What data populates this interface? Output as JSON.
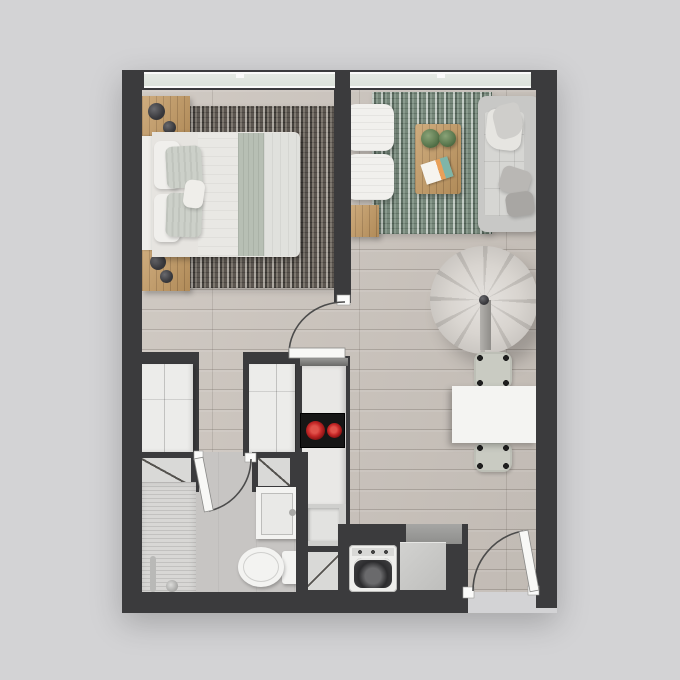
{
  "scene": {
    "kind": "studio-apartment-floor-plan",
    "view": "top-down-3d-render",
    "rooms": [
      "bedroom",
      "living-area",
      "dining-area",
      "kitchenette",
      "bathroom",
      "laundry-nook",
      "entry"
    ]
  },
  "colors": {
    "bg": "#d3d3d5",
    "wall": "#3b3b3d",
    "floorWood": "#ccc5be",
    "floorBath": "#c7c5c3",
    "windowGlass": "#e4e9e3",
    "windowFrame": "#fafaf9",
    "rugBedroomDark": "#6e6963",
    "rugLivingBase": "#8f9e92",
    "furnWood": "#c49a62",
    "white": "#f1f0ed",
    "linen": "#e9e8e4",
    "sage": "#b7bfb4",
    "grayLight": "#d6d6d3",
    "sofa": "#c8c8c6",
    "millworkWhite": "#ececea",
    "panelGray": "#d9d9d7",
    "cooktop": "#161616",
    "burnerRed": "#c62828",
    "burnerDeep": "#7f1010",
    "steel": "#b9b9b7",
    "applianceGray": "#c6c6c4",
    "drumDark": "#2c2c2e",
    "chairSeat": "#c9cbc2",
    "roundChair": "#d9d5d0",
    "roundChairSeam": "#c1bdb8",
    "doorLeaf": "#f8f8f6",
    "doorArc": "#4b4b4b"
  },
  "objects": {
    "bedroom": [
      "double-bed",
      "headboard",
      "white-pillows",
      "sage-pillows",
      "lumbar-pillow",
      "duvet",
      "shag-rug",
      "nightstand-top",
      "nightstand-bottom",
      "table-lamp",
      "wardrobe",
      "window-left"
    ],
    "living": [
      "green-rug",
      "sofa",
      "throw-blanket",
      "sofa-cushions",
      "coffee-table",
      "potted-plant-1",
      "potted-plant-2",
      "magazine",
      "ottoman-1",
      "ottoman-2",
      "wood-side-table",
      "round-swivel-chair",
      "window-right"
    ],
    "dining": [
      "dining-table",
      "dining-chair-north",
      "dining-chair-south"
    ],
    "kitchenette": [
      "tall-cabinet",
      "counter-column",
      "induction-cooktop",
      "kitchen-sink",
      "faucet",
      "base-cabinet-diagonal"
    ],
    "bathroom": [
      "shower",
      "shower-fixture",
      "vanity-sink",
      "toilet",
      "storage-cabinet-left",
      "storage-cabinet-right"
    ],
    "laundry": [
      "washing-machine",
      "appliance-box",
      "counter-patch"
    ],
    "doors": [
      "bedroom-door",
      "bathroom-door",
      "entry-door"
    ]
  }
}
